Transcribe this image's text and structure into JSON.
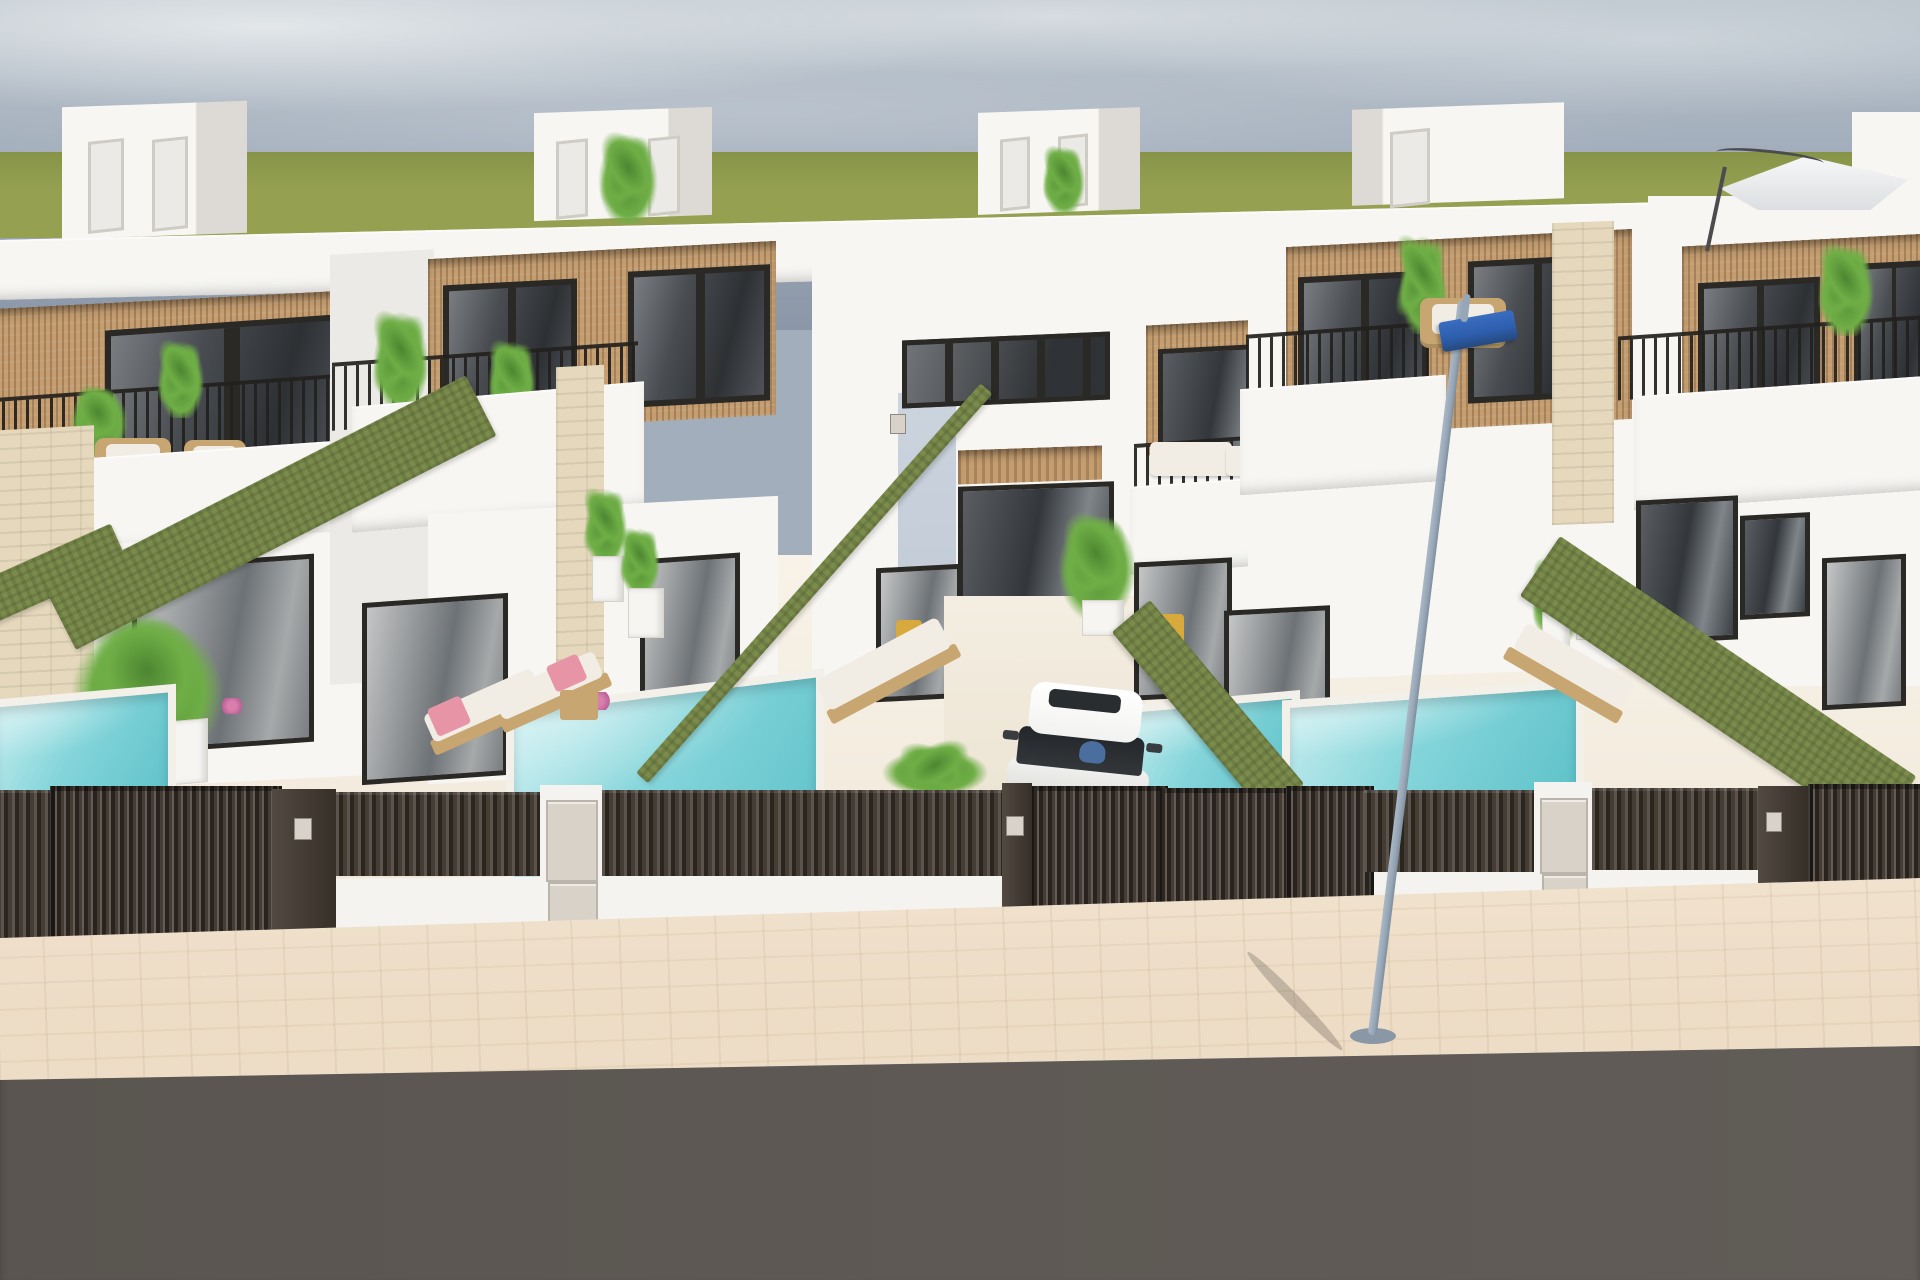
{
  "scene": {
    "type": "architectural-3d-render",
    "description": "Aerial street-side 3D rendering of a row of modern white Mediterranean townhouses with rooftop stair boxes, wood-slat cladding, black-framed glazing, rooftop terraces with railings and plants, private turquoise plunge pools, sun loungers with pink towels, green privacy hedges, dark slatted street gates with utility boxes, a white SUV in a driveway, a street lamp with a blue LED head, a paved sidewalk and an asphalt road under a hazy blue sky",
    "objects": [
      {
        "name": "hazy-blue-sky",
        "color_key": "skyMid"
      },
      {
        "name": "green-horizon-field",
        "color_key": "grass"
      },
      {
        "name": "white-townhouse",
        "count": 5,
        "color_key": "wall"
      },
      {
        "name": "rooftop-stair-box",
        "count": 5,
        "color_key": "wall"
      },
      {
        "name": "wood-slat-cladding-panel",
        "count": 5,
        "color_key": "wood"
      },
      {
        "name": "dark-framed-window",
        "count": 10,
        "color_key": "glass"
      },
      {
        "name": "terrace-railing",
        "count": 5,
        "color_key": "railing"
      },
      {
        "name": "wicker-terrace-chair",
        "count": 4,
        "color_key": "wicker"
      },
      {
        "name": "white-corner-sofa",
        "count": 1,
        "color_key": "cushion"
      },
      {
        "name": "potted-palm",
        "count": 12,
        "color_key": "plant"
      },
      {
        "name": "plunge-pool",
        "count": 4,
        "color_key": "pool"
      },
      {
        "name": "sun-lounger",
        "count": 4,
        "color_key": "cushion"
      },
      {
        "name": "pink-towel",
        "count": 2,
        "color_key": "towel"
      },
      {
        "name": "privacy-hedge",
        "count": 5,
        "color_key": "hedge"
      },
      {
        "name": "travertine-pillar",
        "count": 4,
        "color_key": "stone"
      },
      {
        "name": "dark-slatted-fence-and-gates",
        "color_key": "fence"
      },
      {
        "name": "utility-meter-box",
        "count": 4,
        "color_key": "meterBox"
      },
      {
        "name": "white-suv-with-driver",
        "count": 1,
        "color_key": "carWhite"
      },
      {
        "name": "street-lamp-blue-led-head",
        "count": 1,
        "color_key": "lampBlue"
      },
      {
        "name": "cantilever-parasol",
        "count": 1,
        "color_key": "umbrella"
      },
      {
        "name": "paved-sidewalk",
        "color_key": "sidewalk"
      },
      {
        "name": "asphalt-road",
        "color_key": "road"
      }
    ]
  },
  "palette": {
    "skyTop": "#b7c1c9",
    "skyMid": "#a3aebc",
    "skyLow": "#8b97a8",
    "cloud": "#dde1e4",
    "grass": "#95a051",
    "grassDark": "#879448",
    "wall": "#f7f6f3",
    "wallShade": "#eceae6",
    "wallDark": "#ddd9d4",
    "blueShade": "#ccd4de",
    "wood": "#c59d6f",
    "frame": "#2b2926",
    "glass": "#41454a",
    "curtain": "#e9e7e3",
    "railing": "#23211e",
    "hedge": "#7a8b4b",
    "pool": "#84d5da",
    "poolLight": "#c3ecee",
    "coping": "#f3f0ea",
    "floor": "#f3ecdf",
    "fence": "#453c33",
    "knee": "#f5f3ef",
    "meterBox": "#d9d2c8",
    "stone": "#e5d8bc",
    "sidewalk": "#eddcc6",
    "road": "#5e5954",
    "lampPole": "#97a6b6",
    "lampBlue": "#2e5fae",
    "umbrella": "#eef0f1",
    "carWhite": "#f2f2f0",
    "carGlass": "#33373a",
    "person": "#4a6f9e",
    "wicker": "#c8a671",
    "cushion": "#f1ede5",
    "towel": "#e795a6",
    "plant": "#6fae46",
    "plantDark": "#4c8631",
    "pot": "#f6f5f2",
    "chairYellow": "#d8a93c"
  }
}
